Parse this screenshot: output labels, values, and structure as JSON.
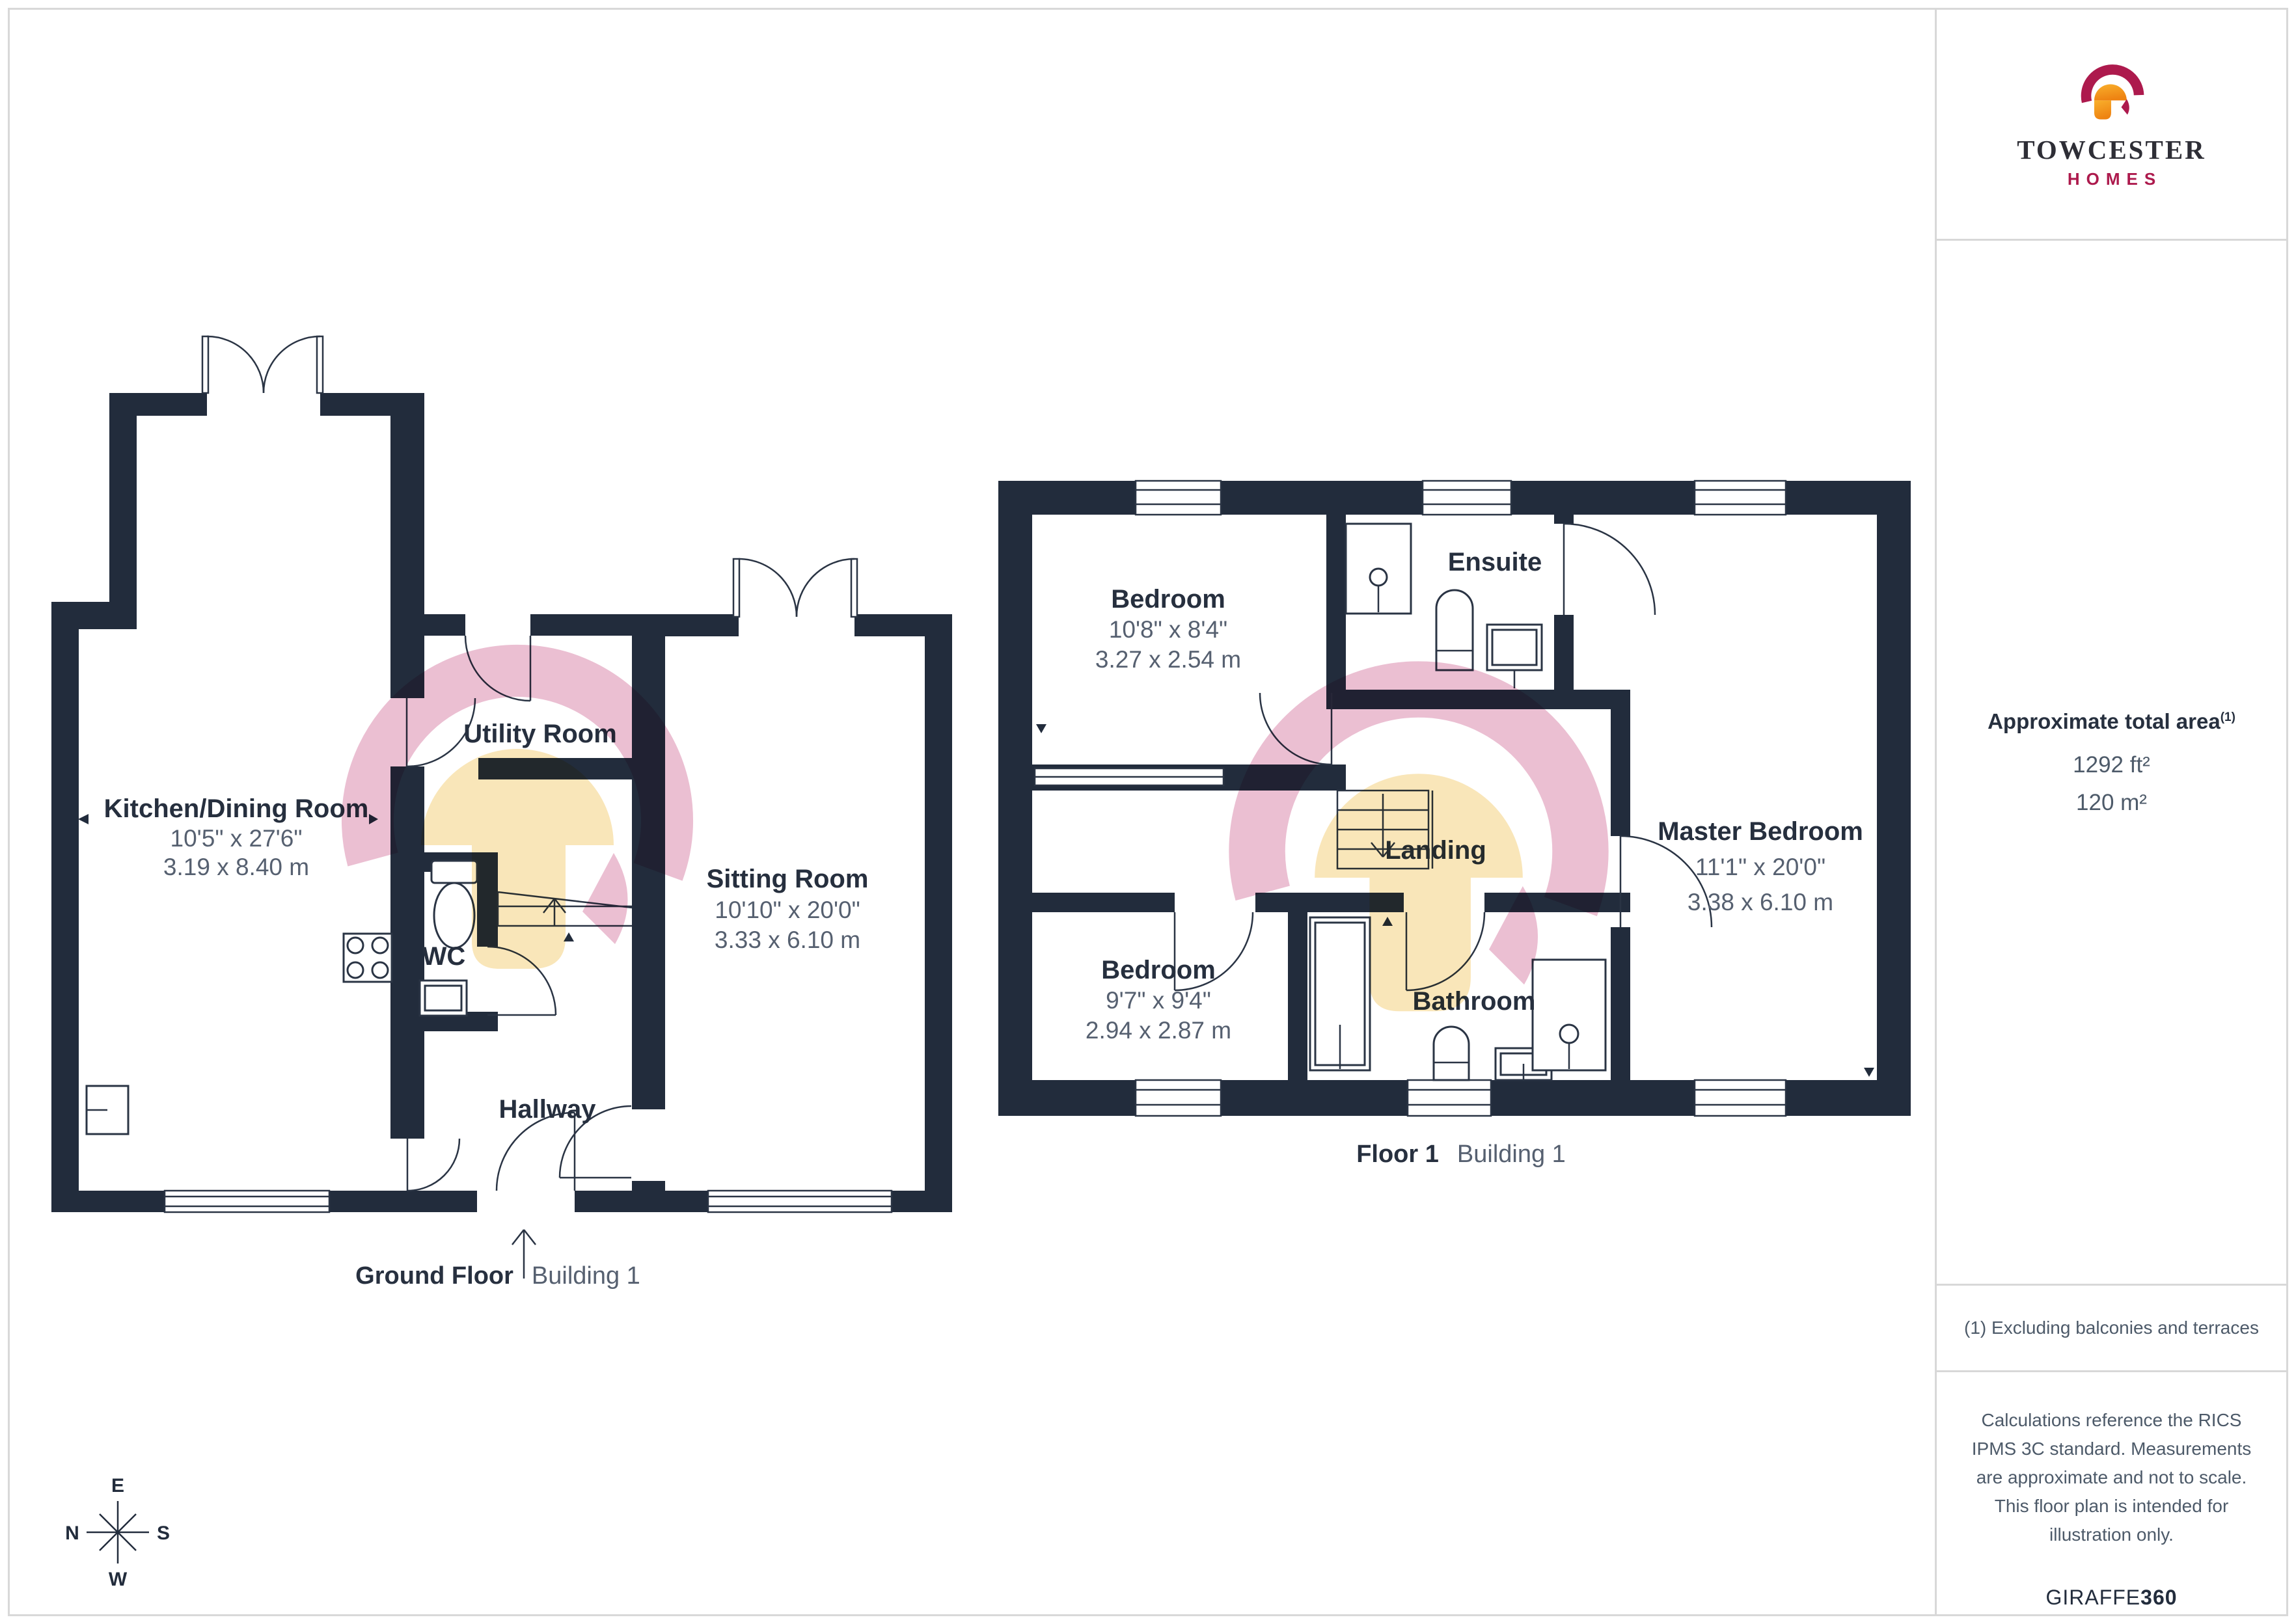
{
  "brand": {
    "title": "TOWCESTER",
    "subtitle": "HOMES",
    "colors": {
      "crimson": "#ad1a4d",
      "orange": "#f2951d",
      "navy": "#222c3c"
    }
  },
  "sidebar": {
    "area_title": "Approximate total area",
    "area_footnote_marker": "(1)",
    "area_imperial": "1292 ft²",
    "area_metric": "120 m²",
    "footnote": "(1) Excluding balconies and terraces",
    "disclaimer": "Calculations reference the RICS IPMS 3C standard. Measurements are approximate and not to scale. This floor plan is intended for illustration only.",
    "credit_brand": "GIRAFFE",
    "credit_suffix": "360"
  },
  "ground_floor": {
    "caption_title": "Ground Floor",
    "caption_subtitle": "Building 1",
    "rooms": {
      "kitchen": {
        "name": "Kitchen/Dining Room",
        "imperial": "10'5\" x 27'6\"",
        "metric": "3.19 x 8.40 m"
      },
      "utility": {
        "name": "Utility Room"
      },
      "wc": {
        "name": "WC"
      },
      "sitting": {
        "name": "Sitting Room",
        "imperial": "10'10\" x 20'0\"",
        "metric": "3.33 x 6.10 m"
      },
      "hallway": {
        "name": "Hallway"
      }
    }
  },
  "floor_1": {
    "caption_title": "Floor 1",
    "caption_subtitle": "Building 1",
    "rooms": {
      "bedroom_front": {
        "name": "Bedroom",
        "imperial": "10'8\" x 8'4\"",
        "metric": "3.27 x 2.54 m"
      },
      "ensuite": {
        "name": "Ensuite"
      },
      "master": {
        "name": "Master Bedroom",
        "imperial": "11'1\" x 20'0\"",
        "metric": "3.38 x 6.10 m"
      },
      "landing": {
        "name": "Landing"
      },
      "bedroom_back": {
        "name": "Bedroom",
        "imperial": "9'7\" x 9'4\"",
        "metric": "2.94 x 2.87 m"
      },
      "bathroom": {
        "name": "Bathroom"
      }
    }
  },
  "compass": {
    "n": "N",
    "e": "E",
    "s": "S",
    "w": "W"
  }
}
